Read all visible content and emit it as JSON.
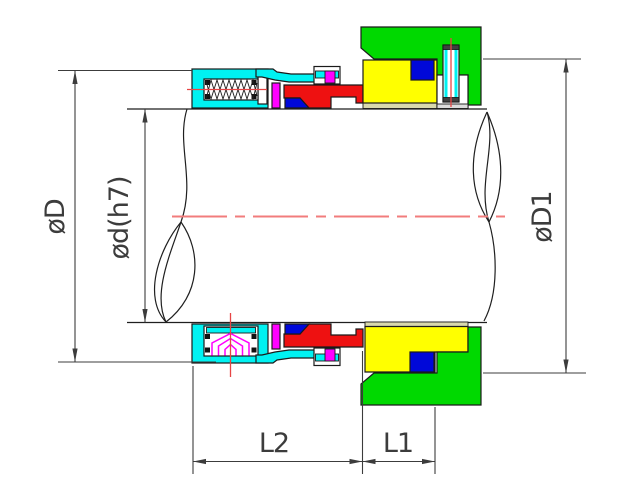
{
  "labels": {
    "outer_diameter": "øD",
    "shaft_diameter": "ød(h7)",
    "seat_diameter": "øD1",
    "length_l2": "L2",
    "length_l1": "L1"
  },
  "colors": {
    "housing": "#00f2f2",
    "gland": "#00d900",
    "seat": "#ffff00",
    "ring": "#ee1111",
    "oring": "#0008d9",
    "spring": "#ff00ff",
    "rim": "#d9d9ad",
    "cavity": "#dcdcdc",
    "centerline": "#f27c7c",
    "pin_line": "#e64545",
    "dim": "#3c3c3c",
    "outline": "#1a1a1a"
  }
}
